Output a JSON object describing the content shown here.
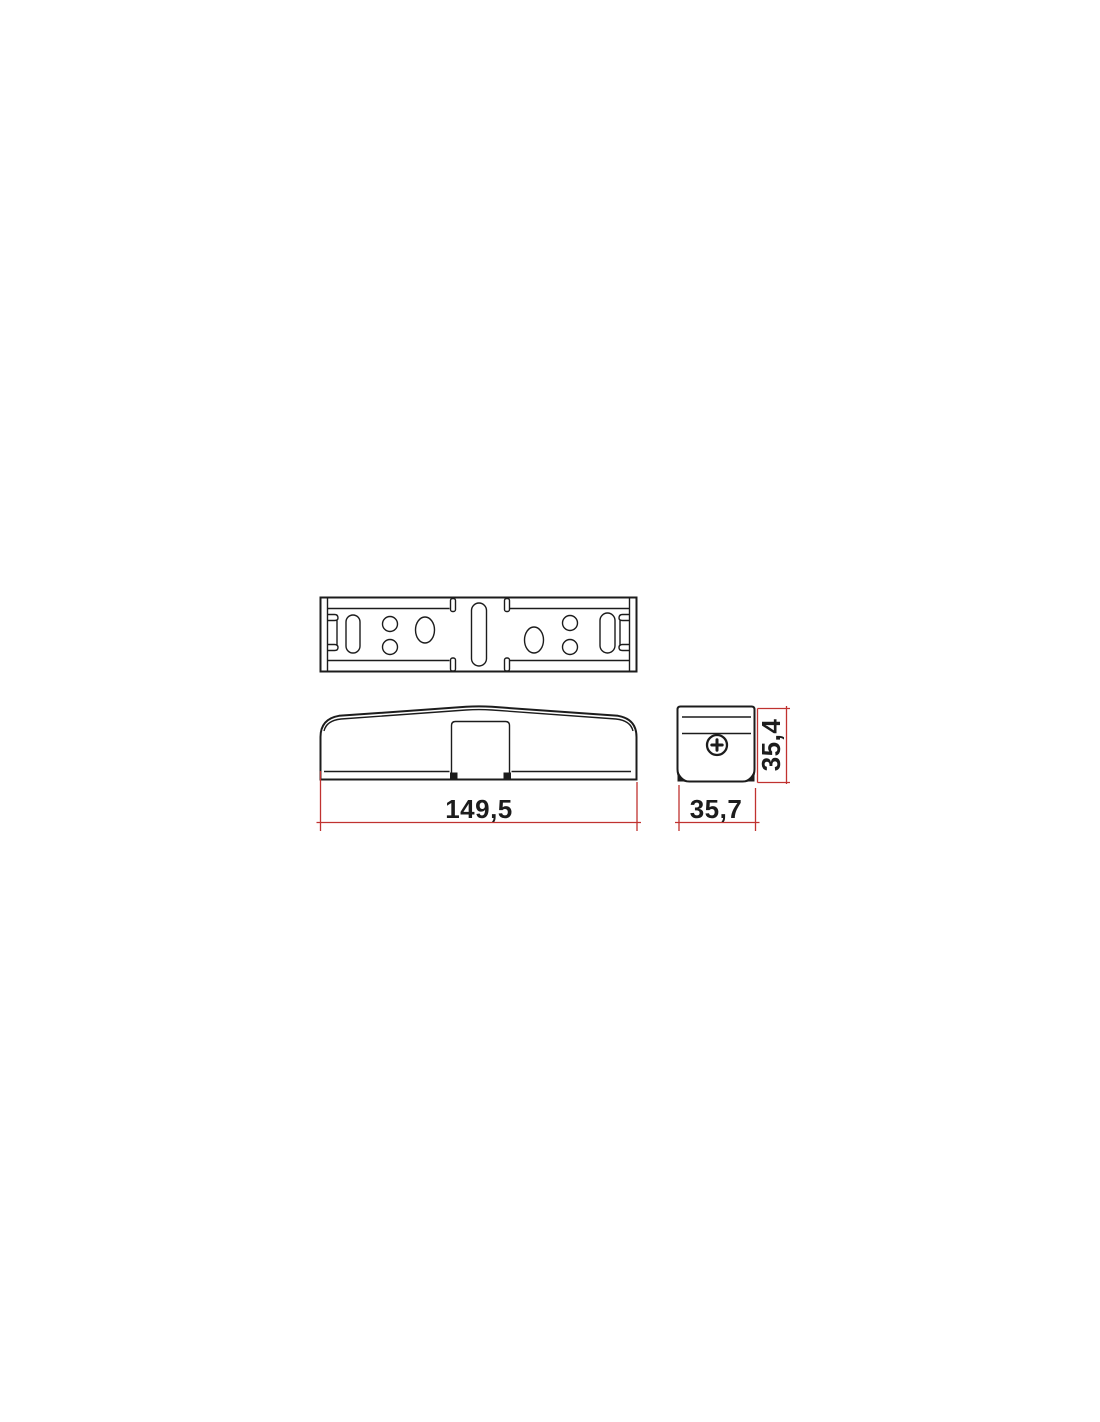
{
  "drawing": {
    "kind": "technical-drawing-three-views",
    "views": {
      "top": "top-view",
      "front": "front-view",
      "side": "side-view"
    },
    "dimensions": {
      "length_mm": "149,5",
      "width_mm": "35,7",
      "height_mm": "35,4"
    },
    "icons": {
      "screw": "phillips-screw-icon"
    },
    "colors": {
      "line": "#1c1c1c",
      "dimension": "#c03230",
      "background": "#ffffff"
    }
  }
}
